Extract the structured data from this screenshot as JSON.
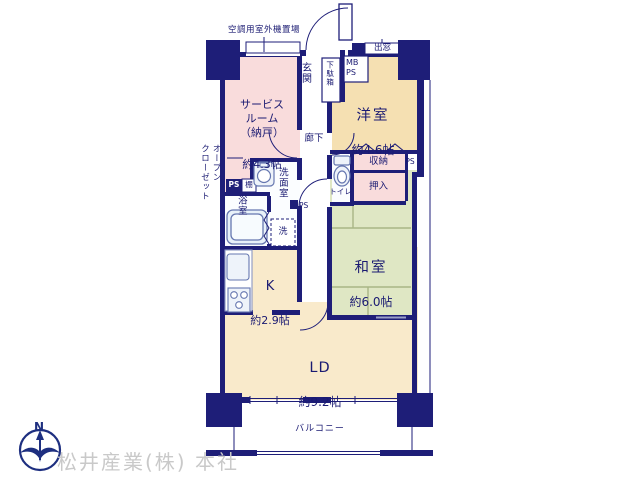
{
  "plan": {
    "labels": {
      "ac_space": "空調用室外機置場",
      "bay_window": "出窓",
      "entrance": "玄関",
      "shoe_box": "下駄箱",
      "meter_box": "MB\nPS",
      "corridor": "廊下",
      "closet": "収納",
      "ps_top": "PS",
      "ps_mid": "PS",
      "ps_small": "PS",
      "shelf": "棚",
      "oshiire": "押入",
      "toilet": "トイレ",
      "washroom": "洗面室",
      "bathroom": "浴室",
      "open_closet": "オープン\nクローゼット",
      "laundry": "洗",
      "balcony": "バルコニー"
    },
    "rooms": {
      "service": {
        "name": "サービス\nルーム\n（納戸）",
        "size": "約4.3帖"
      },
      "western": {
        "name": "洋室",
        "size": "約4.6帖"
      },
      "japanese": {
        "name": "和室",
        "size": "約6.0帖"
      },
      "kitchen": {
        "name": "K",
        "size": "約2.9帖"
      },
      "living": {
        "name": "LD",
        "size": "約9.2帖"
      }
    },
    "compass": {
      "north": "N"
    }
  },
  "watermark": "松井産業(株) 本社",
  "colors": {
    "wall_navy": "#1e1e78",
    "room_pink": "#f9dcdc",
    "room_tan": "#f5e0b2",
    "room_cream": "#f9eacb",
    "room_green": "#dfe7c4",
    "tatami_line": "#a9b685",
    "fixture_stroke": "#6677b0",
    "watermark_gray": "#c9c9c9"
  }
}
